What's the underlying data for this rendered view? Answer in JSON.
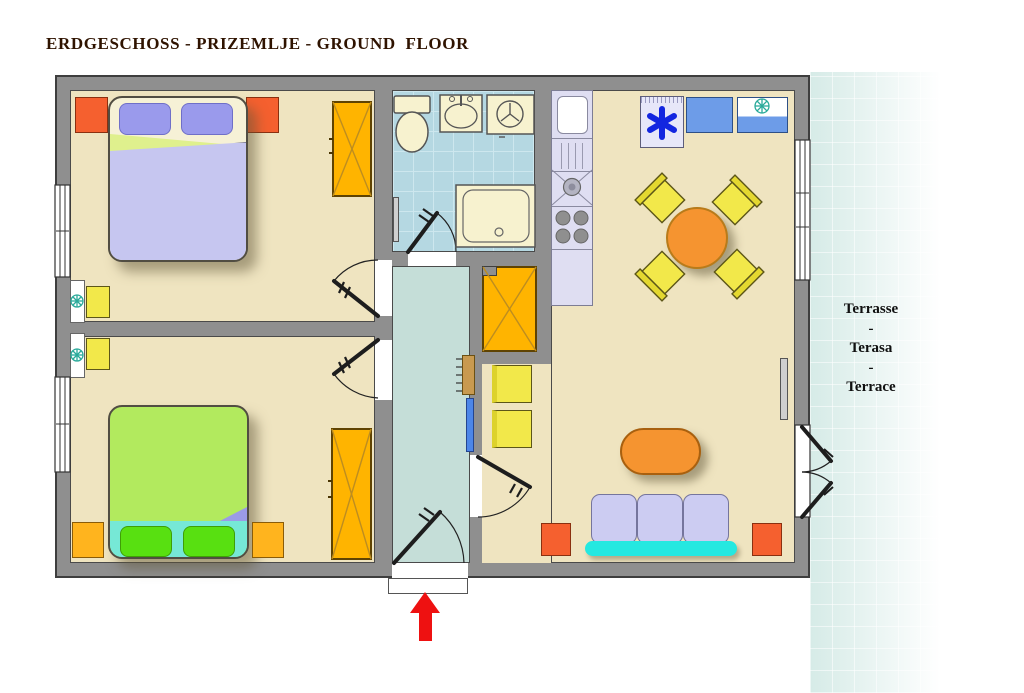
{
  "title": "ERDGESCHOSS - PRIZEMLJE - GROUND  FLOOR",
  "terrace": {
    "text": "Terrasse\n-\nTerasa\n-\nTerrace"
  },
  "entrance": {
    "arrow_direction": "up"
  },
  "colors": {
    "title_color": "#2f1300",
    "wall": "#8f8f8f",
    "floor": "#efe4c0",
    "bath_floor": "#b5d8e2",
    "bath_grid": "#cde7ee",
    "hall_floor": "#c5ded8",
    "terrace": "#d6ebe7",
    "nightstand_red": "#f5602f",
    "nightstand_yellow": "#ffb41e",
    "wardrobe": "#ffb400",
    "bed1_pillow": "#9a9aec",
    "bed1_blanket": "#c6c6f0",
    "bed1_fold": "#dff08d",
    "bed2_blanket": "#b2ea5e",
    "bed2_base": "#76e8d6",
    "bed2_pillow": "#58e011",
    "chair_yellow": "#f2e84a",
    "counter": "#dfdef2",
    "appliance_blue": "#6d9ce8",
    "freezer_asterisk": "#1326e0",
    "snowflake_teal": "#2aaa9a",
    "table_orange": "#f59430",
    "sofa": "#ccccf2",
    "sofa_base": "#25e8e0",
    "arrow_red": "#ee1111"
  }
}
